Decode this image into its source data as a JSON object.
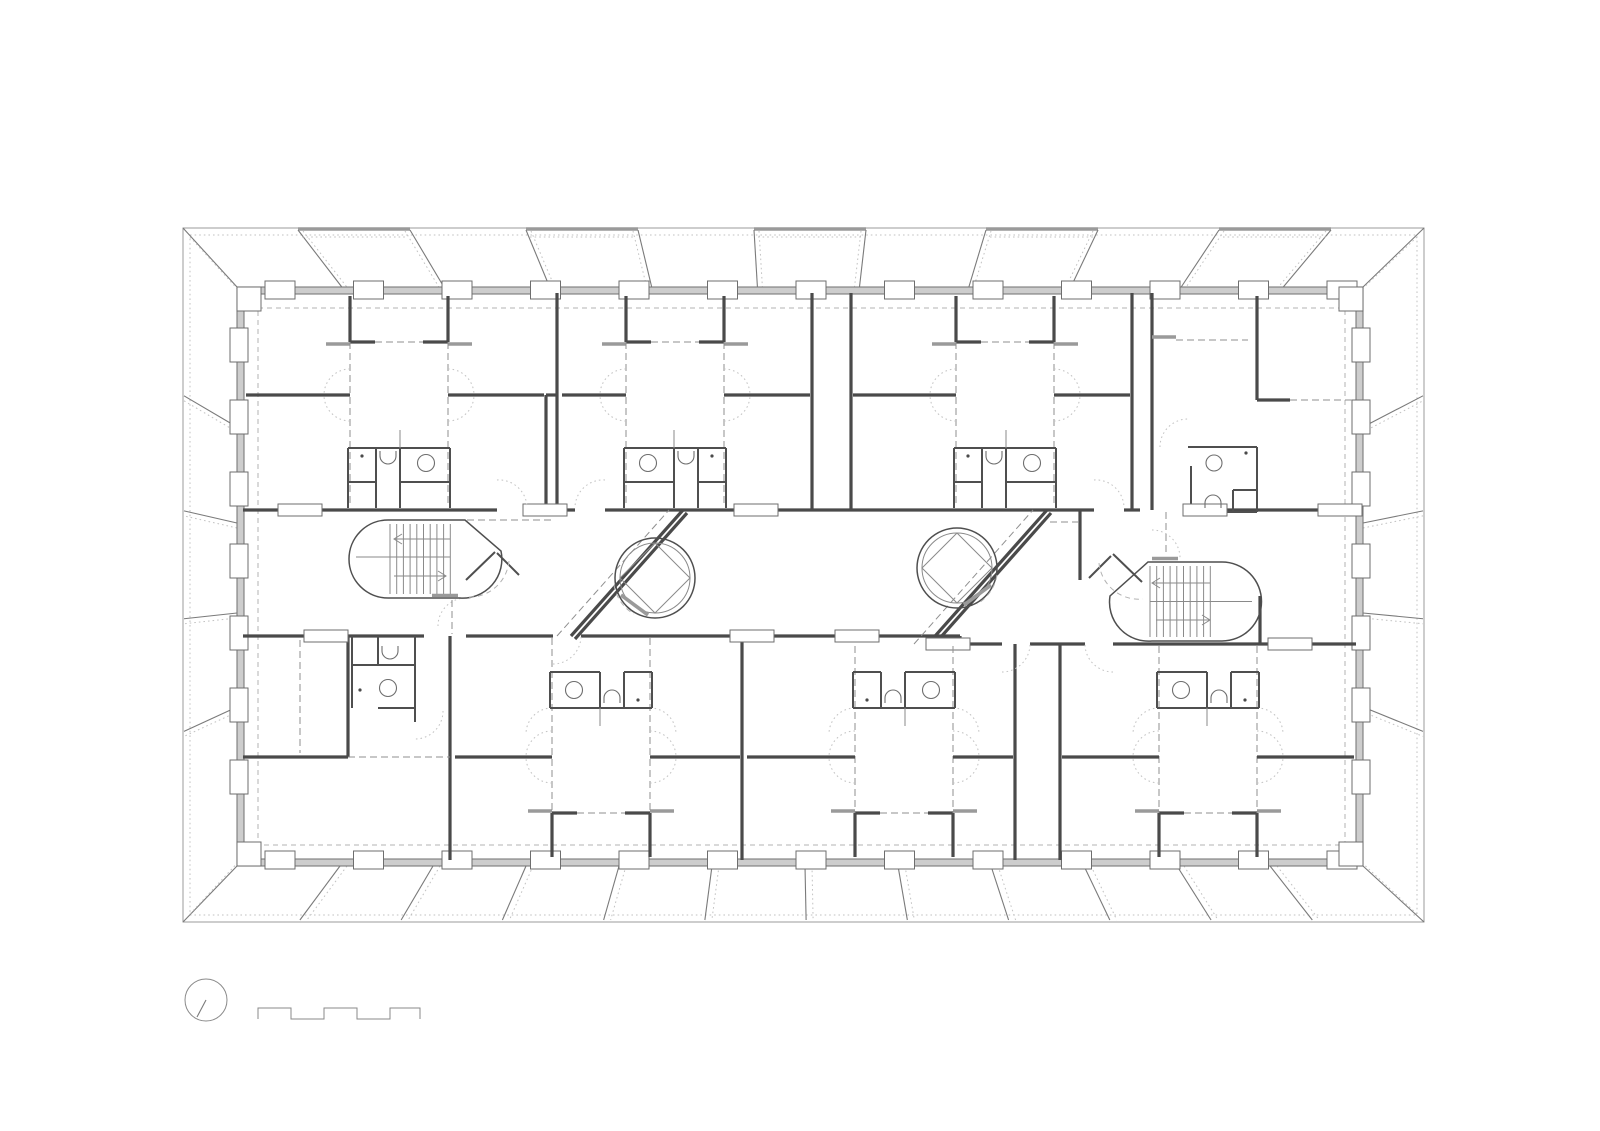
{
  "meta": {
    "drawing_type": "architectural-floor-plan",
    "description": "Typical floor plan of a rectangular apartment building with perimeter canopy panels, two oval stair cores, two circular elevators, and apartment units with central halls and bathroom blocks",
    "visible_text": [],
    "colors": {
      "background": "#ffffff",
      "wall_dark": "#4a4a4a",
      "wall_band": "#cdcdcd",
      "gray_bar": "#9a9a9a",
      "dashed": "#8f8f8f",
      "dotted": "#c2c2c2"
    }
  },
  "plan": {
    "canvas": {
      "w": 1600,
      "h": 1131
    },
    "frame": {
      "outer": [
        183,
        228,
        1424,
        922
      ],
      "dotted_inset": [
        190,
        235,
        1417,
        915
      ],
      "corners": [
        [
          183,
          228,
          237,
          287
        ],
        [
          1424,
          228,
          1363,
          287
        ],
        [
          183,
          922,
          237,
          866
        ],
        [
          1424,
          922,
          1363,
          866
        ]
      ],
      "corners_dotted": [
        [
          190,
          237,
          242,
          294
        ],
        [
          1417,
          237,
          1357,
          294
        ],
        [
          190,
          914,
          242,
          858
        ],
        [
          1417,
          914,
          1357,
          858
        ]
      ],
      "proj": {
        "top": [
          54,
          -0.0886,
          183
        ],
        "bottom": [
          -54,
          0.0886,
          183
        ],
        "side": [
          -59,
          0.1986,
          287
        ]
      },
      "panel_xs": [
        298,
        526,
        754,
        986,
        1219
      ],
      "panel_w": 112,
      "strip_xs": [
        340,
        433,
        526,
        619,
        712,
        805,
        898,
        991,
        1084,
        1177,
        1270
      ],
      "slant_ys": [
        427,
        523,
        613,
        707
      ]
    },
    "building": {
      "x": 237,
      "y": 287,
      "w": 1126,
      "h": 579,
      "t": 7,
      "dash_inset": [
        258,
        308,
        1345,
        845
      ],
      "piers_top": {
        "x0": 280,
        "step": 88.5,
        "n": 13,
        "y": 281,
        "w": 30,
        "h": 18
      },
      "piers_bottom": {
        "x0": 280,
        "step": 88.5,
        "n": 13,
        "y": 851,
        "w": 30,
        "h": 18
      },
      "piers_left": {
        "y0": 345,
        "step": 72,
        "n": 7,
        "x": 230,
        "w": 18,
        "h": 34
      },
      "piers_right": {
        "y0": 345,
        "step": 72,
        "n": 7,
        "x": 1352,
        "w": 18,
        "h": 34
      },
      "corner_blocks": [
        [
          237,
          287
        ],
        [
          1339,
          287
        ],
        [
          237,
          842
        ],
        [
          1339,
          842
        ]
      ],
      "corner_block_size": 24
    },
    "corridor": {
      "walls": [
        [
          243,
          510,
          497,
          510
        ],
        [
          527,
          510,
          575,
          510
        ],
        [
          605,
          510,
          1094,
          510
        ],
        [
          1124,
          510,
          1140,
          510
        ],
        [
          1186,
          510,
          1356,
          510
        ],
        [
          243,
          636,
          424,
          636
        ],
        [
          466,
          636,
          553,
          636
        ],
        [
          581,
          636,
          960,
          636
        ],
        [
          960,
          644,
          1002,
          644
        ],
        [
          1030,
          644,
          1085,
          644
        ],
        [
          1113,
          644,
          1356,
          644
        ],
        [
          960,
          636,
          960,
          644
        ],
        [
          557,
          293,
          557,
          510
        ],
        [
          546,
          395,
          546,
          510
        ],
        [
          546,
          395,
          557,
          395
        ],
        [
          812,
          293,
          812,
          510
        ],
        [
          851,
          293,
          851,
          510
        ],
        [
          1132,
          293,
          1132,
          510
        ],
        [
          1152,
          293,
          1152,
          510
        ],
        [
          450,
          636,
          450,
          860
        ],
        [
          742,
          636,
          742,
          860
        ],
        [
          1015,
          644,
          1015,
          860
        ],
        [
          1060,
          644,
          1060,
          860
        ],
        [
          348,
          636,
          348,
          757
        ],
        [
          243,
          757,
          348,
          757
        ],
        [
          1080,
          510,
          1080,
          580
        ],
        [
          1260,
          596,
          1260,
          644
        ],
        [
          1257,
          296,
          1257,
          400
        ],
        [
          1257,
          400,
          1290,
          400
        ],
        [
          571,
          636,
          683,
          510
        ],
        [
          575,
          639,
          687,
          513
        ],
        [
          928,
          644,
          1047,
          510
        ],
        [
          932,
          647,
          1051,
          513
        ]
      ],
      "walls2": [
        [
          352,
          636,
          352,
          708
        ],
        [
          415,
          636,
          415,
          708
        ],
        [
          378,
          708,
          415,
          708
        ],
        [
          352,
          665,
          415,
          665
        ],
        [
          378,
          636,
          378,
          665
        ],
        [
          415,
          708,
          415,
          722
        ],
        [
          1188,
          447,
          1257,
          447
        ],
        [
          1257,
          447,
          1257,
          512
        ],
        [
          1196,
          512,
          1257,
          512
        ],
        [
          1191,
          466,
          1191,
          512
        ],
        [
          1233,
          490,
          1257,
          490
        ],
        [
          1233,
          490,
          1233,
          512
        ]
      ],
      "bold_bars": [
        [
          1152,
          337,
          1176,
          337
        ]
      ],
      "dashes": [
        [
          1176,
          340,
          1248,
          340
        ],
        [
          1290,
          400,
          1352,
          400
        ],
        [
          348,
          757,
          450,
          757
        ],
        [
          300,
          640,
          300,
          753
        ],
        [
          467,
          520,
          555,
          520
        ],
        [
          557,
          636,
          669,
          510
        ],
        [
          914,
          644,
          1033,
          510
        ],
        [
          1050,
          522,
          1080,
          522
        ]
      ],
      "dot_arcs": [
        "M443,711 A28 28 0 0 1 415,739",
        "M1160,447 A28 28 0 0 1 1188,419",
        "M438,626 A28 28 0 0 1 466,598",
        "M1152,530 A28 28 0 0 1 1180,558"
      ],
      "blocks": [
        [
          278,
          504
        ],
        [
          523,
          504
        ],
        [
          734,
          504
        ],
        [
          1183,
          504
        ],
        [
          1318,
          504
        ],
        [
          304,
          630
        ],
        [
          730,
          630
        ],
        [
          835,
          630
        ],
        [
          926,
          638
        ],
        [
          1268,
          638
        ]
      ],
      "block_w": 44,
      "block_h": 12,
      "fixtures_extra": {
        "circles": [
          [
            388,
            688,
            8.5
          ],
          [
            1214,
            463,
            8
          ]
        ],
        "dots": [
          [
            360,
            690
          ],
          [
            1246,
            453
          ]
        ],
        "toilets": [
          "M382,646 v5 a8 8 0 0 0 16 0 v-5",
          "M1205,508 v-5 a8 8 0 0 1 16 0 v5"
        ]
      }
    },
    "units": {
      "top": [
        {
          "name": "apartment-top-1",
          "l": 244,
          "r": 546,
          "cx": 399,
          "sink": "right",
          "entry": [
            497,
            527,
            "l"
          ]
        },
        {
          "name": "apartment-top-2",
          "l": 560,
          "r": 812,
          "cx": 675,
          "sink": "left",
          "entry": [
            575,
            605,
            "r"
          ]
        },
        {
          "name": "apartment-top-3",
          "l": 851,
          "r": 1132,
          "cx": 1005,
          "sink": "right",
          "entry": [
            1094,
            1124,
            "l"
          ]
        }
      ],
      "bottom": [
        {
          "name": "apartment-bottom-2",
          "l": 453,
          "r": 742,
          "cx": 601,
          "sink": "left",
          "entry": [
            553,
            581,
            "l"
          ],
          "wy": 636
        },
        {
          "name": "apartment-bottom-3",
          "l": 745,
          "r": 1015,
          "cx": 904,
          "sink": "right",
          "entry": [
            1002,
            1030,
            "l"
          ],
          "wy": 644
        },
        {
          "name": "apartment-bottom-4",
          "l": 1060,
          "r": 1356,
          "cx": 1208,
          "sink": "left",
          "entry": [
            1085,
            1113,
            "r"
          ],
          "wy": 644
        }
      ]
    },
    "stairs": [
      {
        "name": "stairwell-left",
        "outline": "M388,520 H465 L501,551 A39 39 0 0 1 460,598 H388 A39 39 0 0 1 388,520 Z",
        "treads": {
          "x0": 390,
          "n": 10,
          "step": 6.7,
          "y0": 524,
          "y1": 594
        },
        "mid": [
          356,
          557,
          450,
          557
        ],
        "arrows": [
          {
            "line": [
              394,
              539,
              450,
              539
            ],
            "head": [
              402,
              534,
              394,
              539,
              402,
              544
            ]
          },
          {
            "line": [
              394,
              576,
              446,
              576
            ],
            "head": [
              438,
              571,
              446,
              576,
              438,
              581
            ]
          }
        ],
        "leaves": [
          [
            466,
            580,
            495,
            552
          ],
          [
            497,
            553,
            519,
            575
          ]
        ],
        "darc": "M509,561 A40 40 0 0 1 465,597",
        "sill": [
          432,
          595.5,
          458,
          595.5
        ],
        "dashes": [
          [
            452,
            600,
            452,
            634
          ]
        ]
      },
      {
        "name": "stairwell-right",
        "outline": "M1222,562 H1148 L1110,596 A39 39 0 0 0 1152,641 H1222 A39.5 39.5 0 0 0 1222,562 Z",
        "treads": {
          "x0": 1150,
          "n": 10,
          "step": 6.7,
          "y0": 566,
          "y1": 637
        },
        "mid": [
          1150,
          601.5,
          1252,
          601.5
        ],
        "arrows": [
          {
            "line": [
              1152,
              583,
              1210,
              583
            ],
            "head": [
              1160,
              578,
              1152,
              583,
              1160,
              588
            ]
          },
          {
            "line": [
              1156,
              620,
              1210,
              620
            ],
            "head": [
              1202,
              615,
              1210,
              620,
              1202,
              625
            ]
          }
        ],
        "leaves": [
          [
            1142,
            582,
            1113,
            554
          ],
          [
            1111,
            556,
            1089,
            578
          ]
        ],
        "darc": "M1099,563 A40 40 0 0 0 1143,599",
        "sill": [
          1152,
          558.5,
          1178,
          558.5
        ],
        "dashes": [
          [
            1166,
            512,
            1166,
            556
          ]
        ]
      }
    ],
    "elevators": [
      {
        "name": "elevator-left",
        "cx": 655,
        "cy": 578,
        "r1": 40,
        "r2": 35,
        "cab": [
          [
            655,
            543
          ],
          [
            690,
            578
          ],
          [
            655,
            613
          ],
          [
            620,
            578
          ]
        ],
        "chord": [
          621,
          595,
          648,
          615
        ],
        "darc": "M614,585 A41 41 0 0 0 634,614"
      },
      {
        "name": "elevator-right",
        "cx": 957,
        "cy": 568,
        "r1": 40,
        "r2": 35,
        "cab": [
          [
            957,
            533
          ],
          [
            992,
            568
          ],
          [
            957,
            603
          ],
          [
            922,
            568
          ]
        ],
        "chord": [
          964,
          605,
          991,
          585
        ],
        "darc": "M997,575 A41 41 0 0 1 977,604"
      }
    ],
    "legend": {
      "north": {
        "cx": 206,
        "cy": 1000,
        "r": 21,
        "needle": [
          197,
          1017,
          206,
          1000
        ]
      },
      "scalebar": "M258,1019 L258,1008 L291,1008 L291,1019 L324,1019 L324,1008 L357,1008 L357,1019 L390,1019 L390,1008 L420,1008 L420,1019"
    }
  }
}
